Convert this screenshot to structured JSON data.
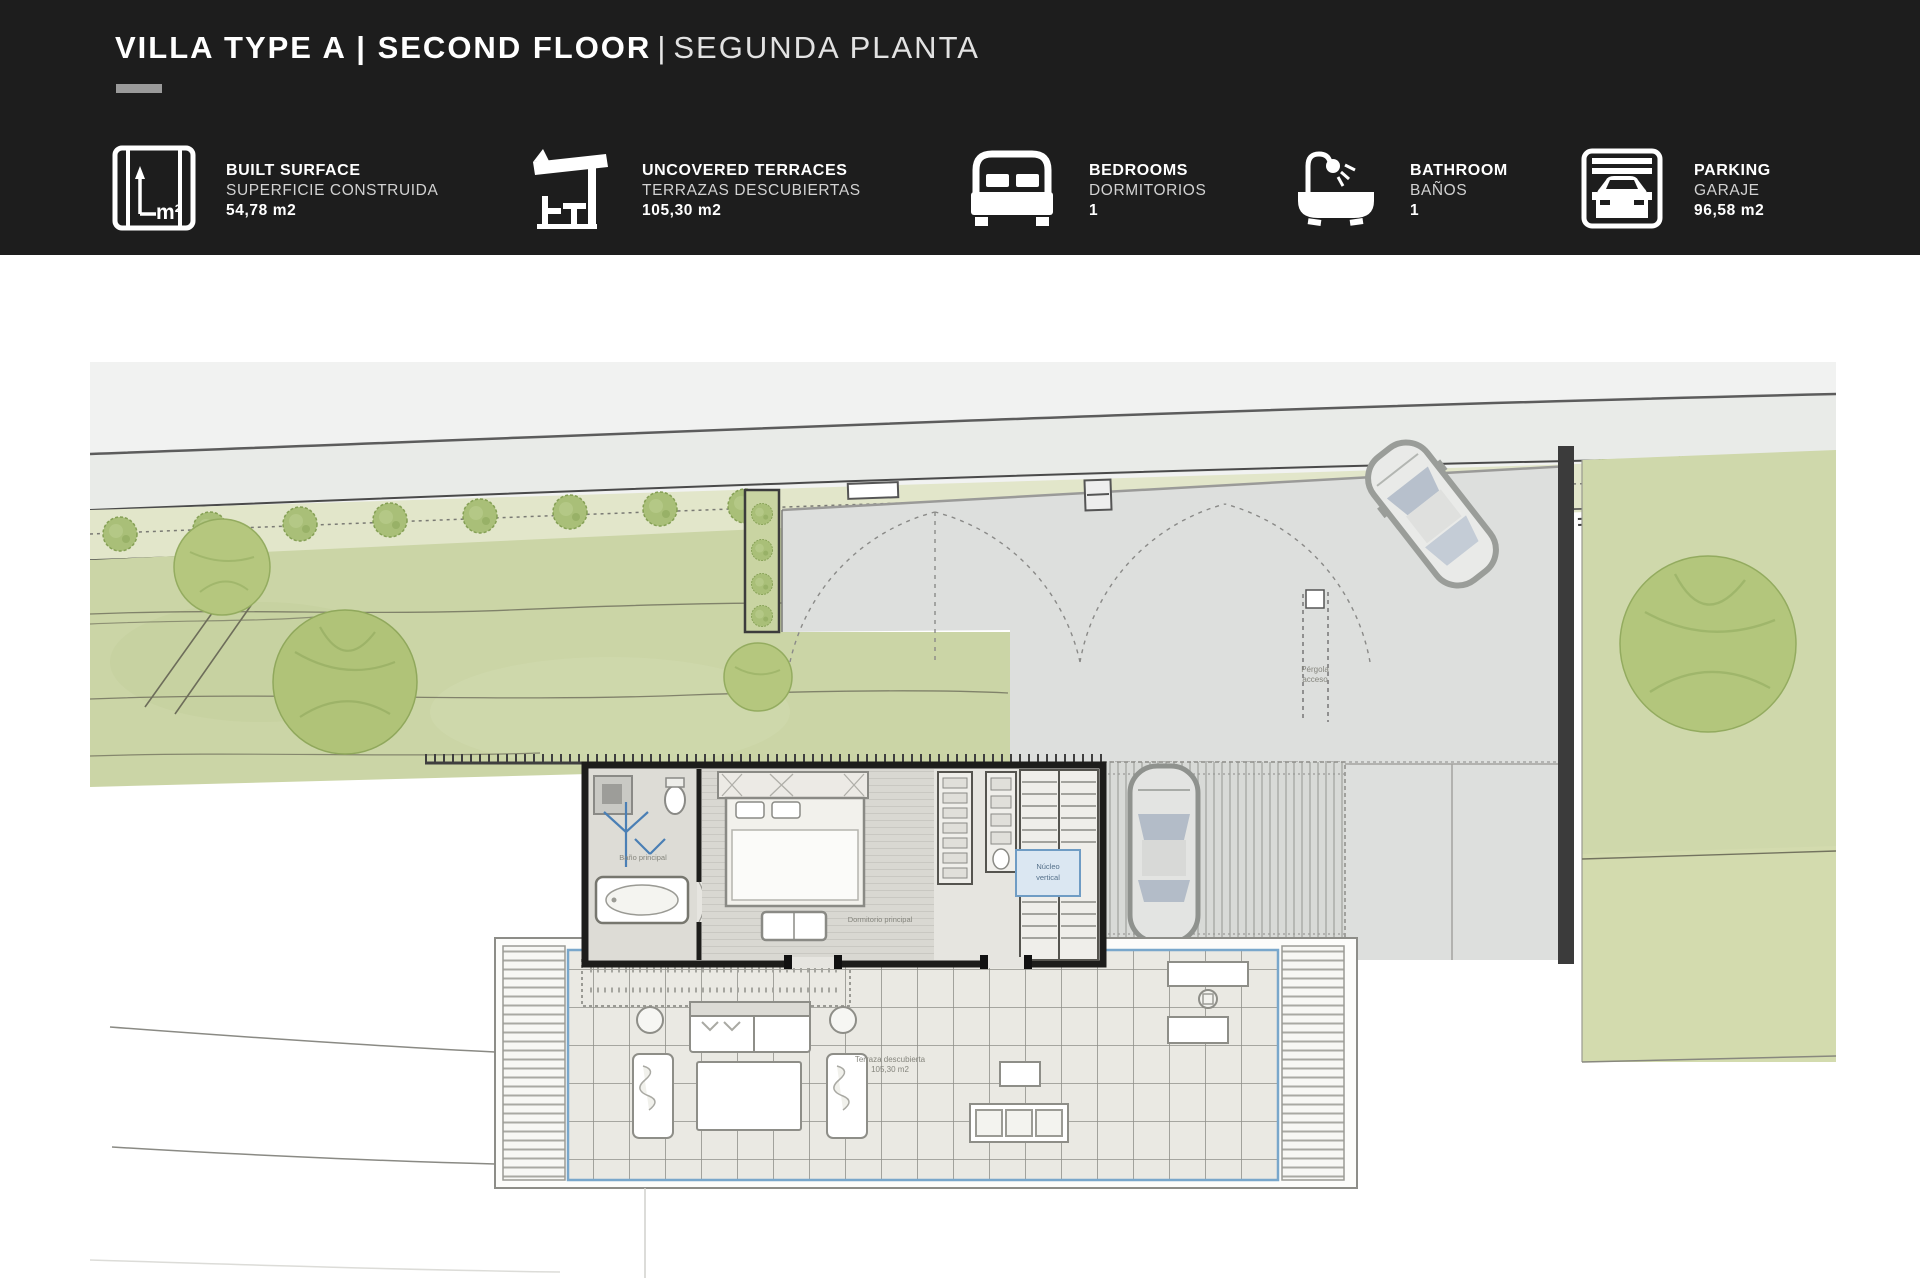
{
  "header": {
    "title_bold": "VILLA TYPE A | SECOND FLOOR",
    "title_sep": "|",
    "title_light": "SEGUNDA PLANTA",
    "stats": [
      {
        "label_en": "BUILT SURFACE",
        "label_es": "SUPERFICIE CONSTRUIDA",
        "value": "54,78 m2",
        "icon": "blueprint-m2-icon"
      },
      {
        "label_en": "UNCOVERED TERRACES",
        "label_es": "TERRAZAS DESCUBIERTAS",
        "value": "105,30 m2",
        "icon": "pergola-icon"
      },
      {
        "label_en": "BEDROOMS",
        "label_es": "DORMITORIOS",
        "value": "1",
        "icon": "bed-icon"
      },
      {
        "label_en": "BATHROOM",
        "label_es": "BAÑOS",
        "value": "1",
        "icon": "bathtub-icon"
      },
      {
        "label_en": "PARKING",
        "label_es": "GARAJE",
        "value": "96,58 m2",
        "icon": "garage-car-icon"
      }
    ]
  },
  "plan": {
    "bathroom_label": "Baño principal",
    "bedroom_label": "Dormitorio principal",
    "stairs_label_1": "Núcleo",
    "stairs_label_2": "vertical",
    "terrace_label": "Terraza descubierta",
    "terrace_area": "105,30 m2",
    "pergola_label_1": "Pérgola",
    "pergola_label_2": "acceso"
  },
  "colors": {
    "header_bg": "#1d1d1d",
    "lawn": "#cbd5a6",
    "tree": "#b5c77e",
    "paving": "#dddfdd",
    "deck_border_blue": "#79a7cb",
    "wall_dark": "#1d1d1b"
  }
}
